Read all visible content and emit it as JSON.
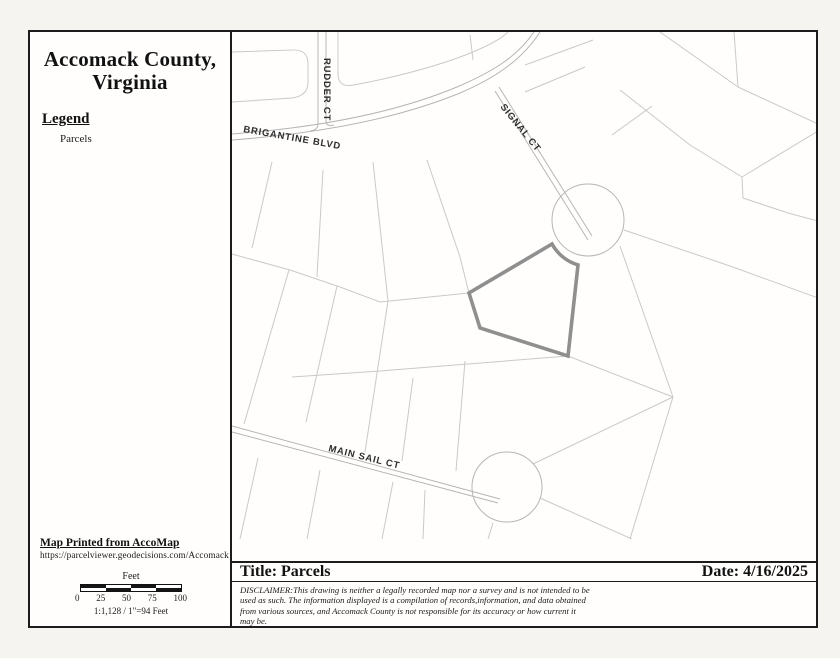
{
  "header": {
    "title_line1": "Accomack County,",
    "title_line2": "Virginia"
  },
  "legend": {
    "heading": "Legend",
    "items": [
      {
        "label": "Parcels"
      }
    ]
  },
  "footer_left": {
    "printed_from": "Map Printed from AccoMap",
    "url": "https://parcelviewer.geodecisions.com/Accomack",
    "scale_unit_label": "Feet",
    "scale_ticks": [
      "0",
      "25",
      "50",
      "75",
      "100"
    ],
    "scale_ratio": "1:1,128 / 1\"=94 Feet"
  },
  "map": {
    "road_labels": {
      "rudder": "RUDDER CT",
      "brigantine": "BRIGANTINE BLVD",
      "signal": "SIGNAL CT",
      "main_sail": "MAIN SAIL CT"
    },
    "colors": {
      "parcel_line": "#c9c9c9",
      "road_line": "#b5b5b5",
      "highlight_parcel": "#8f8f8f"
    }
  },
  "title_bar": {
    "title": "Title: Parcels",
    "date": "Date: 4/16/2025",
    "disclaimer": "DISCLAIMER:This drawing is neither a legally recorded map nor a survey and is not intended to be used as such.  The information displayed is a compilation of records,information, and data obtained from various sources, and Accomack County is not responsible for its accuracy or how current it may be."
  }
}
